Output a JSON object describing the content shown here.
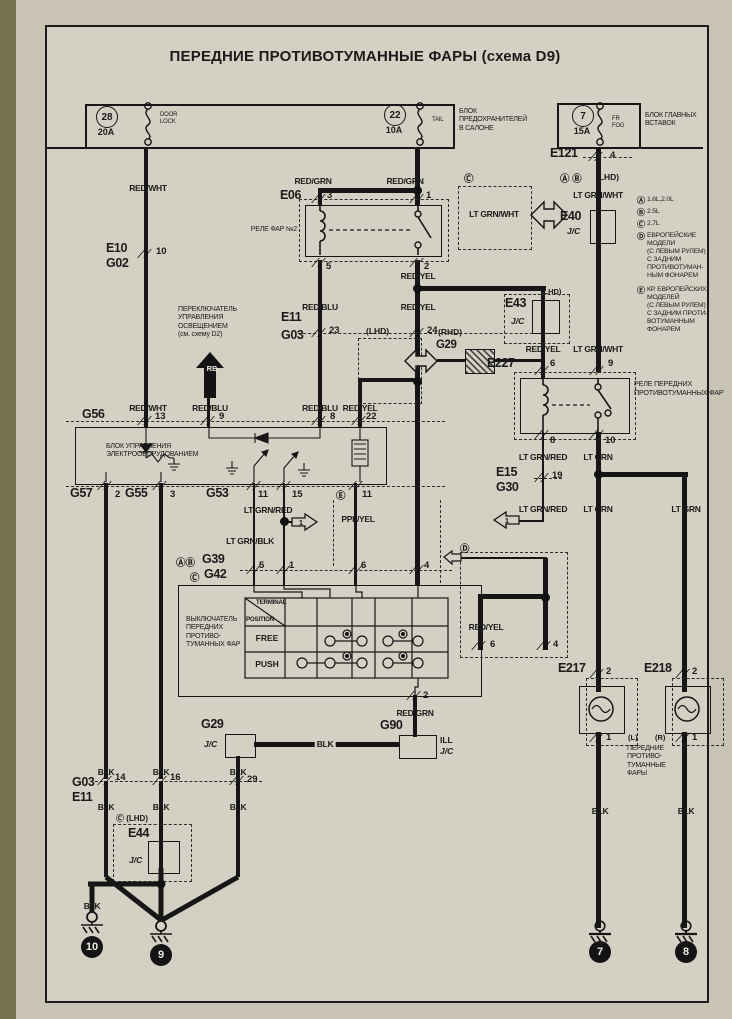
{
  "colors": {
    "paper": "#d4d0c3",
    "ink": "#1b1b1b",
    "page_edge": "#b5ae93"
  },
  "title": "ПЕРЕДНИЕ ПРОТИВОТУМАННЫЕ ФАРЫ (схема D9)",
  "wire_colors": {
    "red_wht": "RED/WHT",
    "red_grn": "RED/GRN",
    "red_blu": "RED/BLU",
    "red_yel": "RED/YEL",
    "lt_grn_wht": "LT GRN/WHT",
    "lt_grn_red": "LT GRN/RED",
    "lt_grn_blk": "LT GRN/BLK",
    "lt_grn": "LT GRN",
    "ppl_yel": "PPL/YEL",
    "blk": "BLK"
  },
  "fuse_boxes": {
    "cabin": {
      "label": "БЛОК\nПРЕДОХРАНИТЕЛЕЙ\nВ САЛОНЕ"
    },
    "main": {
      "label": "БЛОК ГЛАВНЫХ\nВСТАВОК"
    }
  },
  "fuses": {
    "f28": {
      "num": "28",
      "amp": "20A",
      "circuit": "DOOR\nLOCK"
    },
    "f22": {
      "num": "22",
      "amp": "10A",
      "circuit": "TAIL"
    },
    "f7": {
      "num": "7",
      "amp": "15A",
      "circuit": "FR\nFOG"
    }
  },
  "legend": {
    "items": [
      {
        "key": "Ⓐ",
        "text": "1.6L,2.0L"
      },
      {
        "key": "Ⓑ",
        "text": "2.5L"
      },
      {
        "key": "Ⓒ",
        "text": "2.7L"
      },
      {
        "key": "Ⓓ",
        "text": "ЕВРОПЕЙСКИЕ\nМОДЕЛИ\n(С ЛЕВЫМ РУЛЕМ)\nС ЗАДНИМ\nПРОТИВОТУМАН-\nНЫМ ФОНАРЕМ"
      },
      {
        "key": "Ⓔ",
        "text": "КР. ЕВРОПЕЙСКИХ\nМОДЕЛЕЙ\n(С ЛЕВЫМ РУЛЕМ)\nС ЗАДНИМ ПРОТИ-\nВОТУМАННЫМ\nФОНАРЕМ"
      }
    ]
  },
  "tags": {
    "lhd": "(LHD)",
    "rhd": "(RHD)",
    "ab": "Ⓐ Ⓑ",
    "c": "Ⓒ",
    "d": "Ⓓ",
    "e": "Ⓔ",
    "c_lhd": "Ⓒ (LHD)",
    "left": "(L)",
    "right": "(R)",
    "jc": "J/C",
    "arrow1": "1",
    "rb": "RB",
    "ill": "ILL"
  },
  "connectors": {
    "e121": {
      "id": "E121",
      "pin4": "4"
    },
    "e40": {
      "id": "E40"
    },
    "e10": {
      "id": "E10",
      "id2": "G02",
      "pin10": "10"
    },
    "e06": {
      "id": "E06",
      "pin3": "3",
      "pin1": "1",
      "pin5": "5",
      "pin2": "2"
    },
    "e11": {
      "id": "E11",
      "id2": "G03",
      "pin23": "23",
      "pin24": "24"
    },
    "g29_mid": {
      "id": "G29"
    },
    "e43": {
      "id": "E43"
    },
    "e227": {
      "id": "E227",
      "pin6": "6",
      "pin9": "9",
      "pin8": "8",
      "pin10": "10"
    },
    "e15": {
      "id": "E15",
      "id2": "G30",
      "pin19": "19"
    },
    "g56": {
      "id": "G56",
      "pin13": "13",
      "pin9": "9",
      "pin8": "8",
      "pin22": "22"
    },
    "g57": {
      "id": "G57",
      "pin2": "2"
    },
    "g55": {
      "id": "G55",
      "pin3": "3"
    },
    "g53": {
      "id": "G53",
      "pin11": "11",
      "pin15": "15"
    },
    "e_pin": {
      "pin11": "11"
    },
    "g39": {
      "ab": "ⒶⒷ",
      "id": "G39"
    },
    "g42": {
      "c": "Ⓒ",
      "id": "G42",
      "pin5": "5",
      "pin1": "1",
      "pin6": "6",
      "pin4": "4"
    },
    "sw_pin2": "2",
    "d_box": {
      "pin6": "6",
      "pin4": "4"
    },
    "g90": {
      "id": "G90"
    },
    "g29_jc": {
      "id": "G29",
      "pin29": "29"
    },
    "g03": {
      "id": "G03",
      "id2": "E11",
      "pin14": "14",
      "pin16": "16",
      "pin29": "29"
    },
    "e44": {
      "id": "E44"
    },
    "e217": {
      "id": "E217",
      "pin2": "2",
      "pin1": "1"
    },
    "e218": {
      "id": "E218",
      "pin2": "2",
      "pin1": "1"
    }
  },
  "labels": {
    "relay2": "РЕЛЕ ФАР №2",
    "fog_relay": "РЕЛЕ ПЕРЕДНИХ\nПРОТИВОТУМАННЫХ ФАР",
    "control_unit": "БЛОК УПРАВЛЕНИЯ\nЭЛЕКТРООБОРУДОВАНИЕМ",
    "light_switch": "ПЕРЕКЛЮЧАТЕЛЬ\nУПРАВЛЕНИЯ\nОСВЕЩЕНИЕМ\n(см. схему D2)",
    "fog_switch": "ВЫКЛЮЧАТЕЛЬ\nПЕРЕДНИХ\nПРОТИВО-\nТУМАННЫХ ФАР",
    "fog_lamps": "ПЕРЕДНИЕ\nПРОТИВО-\nТУМАННЫЕ\nФАРЫ"
  },
  "switch_table": {
    "terminal": "TERMINAL",
    "position": "POSITION",
    "free": "FREE",
    "push": "PUSH"
  },
  "grounds": {
    "g10": "10",
    "g9": "9",
    "g7": "7",
    "g8": "8"
  }
}
